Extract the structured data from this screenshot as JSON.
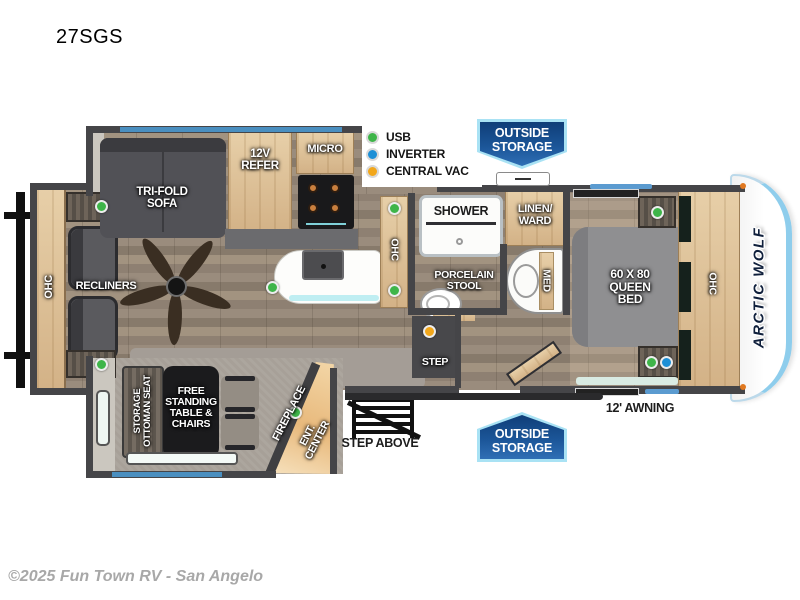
{
  "page": {
    "title": "27SGS",
    "footer": "©2025 Fun Town RV - San Angelo"
  },
  "brand": {
    "name": "ARCTIC WOLF"
  },
  "colors": {
    "usb_green": "#3eb549",
    "inverter_blue": "#1d8fd6",
    "central_vac_orange": "#f2a71b",
    "badge_blue": "#1b5598",
    "badge_border": "#a9e2f4",
    "window_blue": "#4a8fc0",
    "wall_gray": "#454548",
    "cabinet_wood": "#d9b88c"
  },
  "legend": {
    "items": [
      {
        "label": "USB",
        "color": "#3eb549"
      },
      {
        "label": "INVERTER",
        "color": "#1d8fd6"
      },
      {
        "label": "CENTRAL VAC",
        "color": "#f2a71b"
      }
    ]
  },
  "badges": {
    "top": "OUTSIDE\nSTORAGE",
    "bottom": "OUTSIDE\nSTORAGE"
  },
  "labels": {
    "sofa": "TRI-FOLD\nSOFA",
    "refer": "12V\nREFER",
    "micro": "MICRO",
    "ohc_rear": "OHC",
    "recliners": "RECLINERS",
    "ohc_kitchen": "OHC",
    "shower": "SHOWER",
    "linen": "LINEN/\nWARD",
    "stool": "PORCELAIN\nSTOOL",
    "med": "MED",
    "bed": "60 X 80\nQUEEN\nBED",
    "ohc_bedroom": "OHC",
    "step": "STEP",
    "ottoman": "STORAGE\nOTTOMAN SEAT",
    "table": "FREE\nSTANDING\nTABLE &\nCHAIRS",
    "fireplace": "FIREPLACE",
    "ent_center": "ENT.\nCENTER",
    "step_above": "STEP ABOVE",
    "awning": "12' AWNING"
  }
}
